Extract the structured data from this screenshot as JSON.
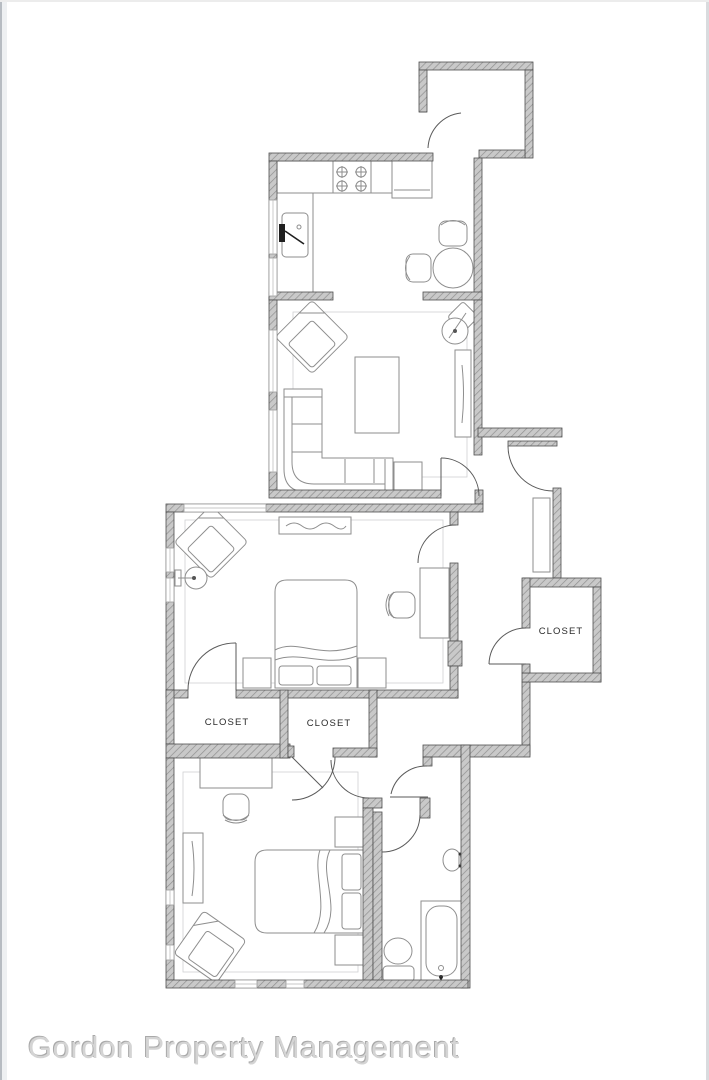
{
  "labels": {
    "closet_bedroom1": "CLOSET",
    "closet_bedroom2": "CLOSET",
    "closet_hall": "CLOSET"
  },
  "watermark": {
    "text": "Gordon Property Management"
  },
  "colors": {
    "wall-fill": "#c9c9c9",
    "wall-hatch": "#8f8f8f",
    "wall-stroke": "#4f4f4f",
    "furniture": "#8e8e8e",
    "furniture-dark": "#1f1f1f",
    "thin": "#cfd1d3",
    "door": "#5a5a5a",
    "label": "#2b2b2b",
    "watermark": "#d4d4d4",
    "watermark-shadow": "#a9a9a9",
    "page-edge": "#b7bcc2"
  }
}
